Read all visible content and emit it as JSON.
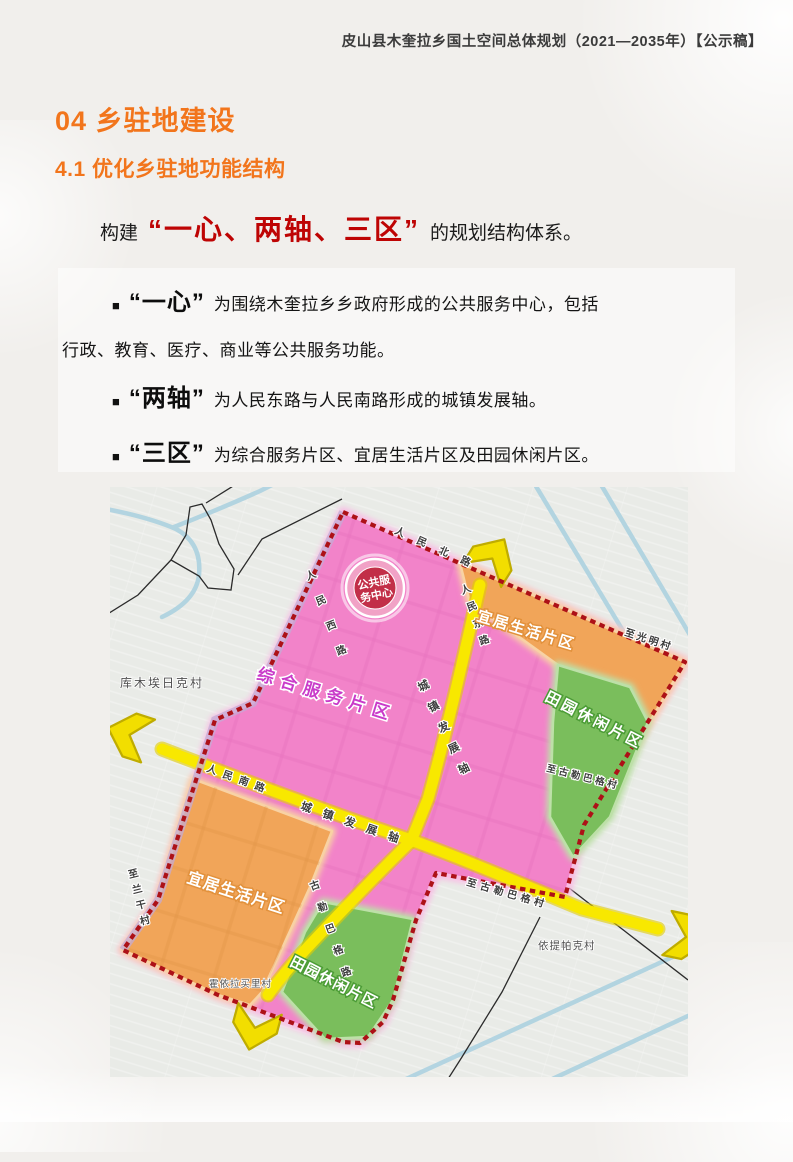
{
  "page": {
    "doc_header": "皮山县木奎拉乡国土空间总体规划（2021—2035年）【公示稿】",
    "section_title": "04 乡驻地建设",
    "subsection_title": "4.1  优化乡驻地功能结构",
    "intro": {
      "prefix": "构建",
      "highlight": "“一心、两轴、三区”",
      "suffix": "的规划结构体系。"
    },
    "bullet_marker": "■",
    "bullets": [
      {
        "term": "“一心”",
        "text": "为围绕木奎拉乡乡政府形成的公共服务中心，包括",
        "text2": "行政、教育、医疗、商业等公共服务功能。"
      },
      {
        "term": "“两轴”",
        "text": "为人民东路与人民南路形成的城镇发展轴。",
        "text2": ""
      },
      {
        "term": "“三区”",
        "text": "为综合服务片区、宜居生活片区及田园休闲片区。",
        "text2": ""
      }
    ]
  },
  "map": {
    "marker": {
      "line1": "公共服",
      "line2": "务中心"
    },
    "zones": {
      "comprehensive": "综合服务片区",
      "livable_tr": "宜居生活片区",
      "pastoral_r": "田园休闲片区",
      "livable_bl": "宜居生活片区",
      "pastoral_b": "田园休闲片区"
    },
    "roads": {
      "renmin_north": "人民北路",
      "renmin_west": "人民西路",
      "renmin_east": "人民东路",
      "renmin_south": "人民南路",
      "axis_vertical": "城镇发展轴",
      "axis_horizontal": "城镇发展轴",
      "gulebage_road": "古勒巴格路",
      "to_gulebage": "至古勒巴格村",
      "to_gulebage_inner": "至古勒巴格村",
      "to_guangming": "至光明村",
      "to_langan": "至兰干村"
    },
    "villages": {
      "kumuairike": "库木埃日克村",
      "huoyilamaili": "霍依拉买里村",
      "yitipake": "依提帕克村"
    },
    "colors": {
      "pink": "#F283C9",
      "orange": "#F1A559",
      "green": "#7ABE5C",
      "axis_yellow": "#F8E800",
      "boundary_red": "#AD1117",
      "marker_red": "#C22F48"
    }
  }
}
